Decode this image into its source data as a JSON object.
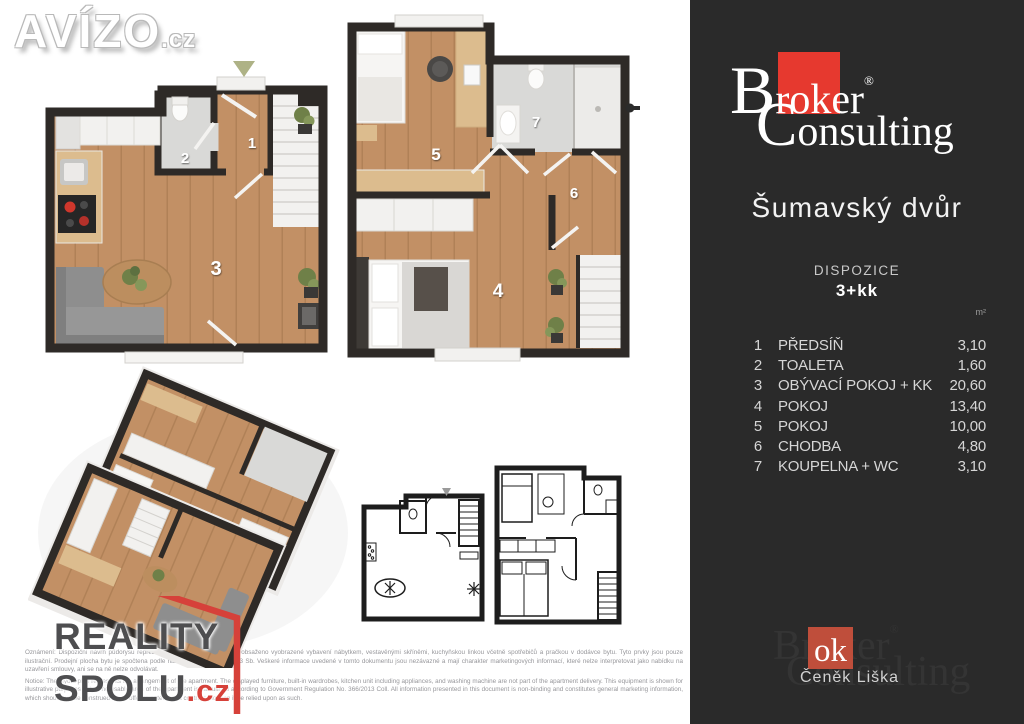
{
  "watermark_logo": {
    "brand": "AVÍZO",
    "tld": ".cz"
  },
  "sidebar": {
    "brand": {
      "cap1": "B",
      "rest1a": "r",
      "ok": "ok",
      "rest1b": "er",
      "reg": "®",
      "cap2": "C",
      "rest2": "onsulting"
    },
    "property_title": "Šumavský dvůr",
    "disposition_label": "DISPOZICE",
    "disposition_value": "3+kk",
    "area_unit": "m²",
    "rooms": [
      {
        "num": "1",
        "name": "PŘEDSÍŇ",
        "area": "3,10"
      },
      {
        "num": "2",
        "name": "TOALETA",
        "area": "1,60"
      },
      {
        "num": "3",
        "name": "OBÝVACÍ POKOJ + KK",
        "area": "20,60"
      },
      {
        "num": "4",
        "name": "POKOJ",
        "area": "13,40"
      },
      {
        "num": "5",
        "name": "POKOJ",
        "area": "10,00"
      },
      {
        "num": "6",
        "name": "CHODBA",
        "area": "4,80"
      },
      {
        "num": "7",
        "name": "KOUPELNA + WC",
        "area": "3,10"
      }
    ],
    "watermark": {
      "line1": "Broker",
      "reg": "®",
      "line2": "Consulting"
    },
    "agent": {
      "badge": "ok",
      "name": "Čeněk Liška"
    }
  },
  "plans": {
    "ground": {
      "labels": {
        "hall": "1",
        "toilet": "2",
        "living": "3"
      }
    },
    "upper": {
      "labels": {
        "room4": "4",
        "room5": "5",
        "corridor": "6",
        "bathroom": "7"
      }
    }
  },
  "footer_logo": {
    "line1": "REALITY",
    "line2": "SPOLU",
    "tld": ".cz"
  },
  "disclaimer": {
    "cz": "Oznámení: Dispoziční návrh půdorysu reprezentuje uspořádání bytu. Není obsaženo vyobrazené vybavení nábytkem, vestavěnými skříněmi, kuchyňskou linkou včetně spotřebičů a pračkou v dodávce bytu. Tyto prvky jsou pouze ilustrační. Prodejní plocha bytu je spočtena podle nařízení vlády č. 366/2013 Sb. Veškeré informace uvedené v tomto dokumentu jsou nezávazné a mají charakter marketingových informací, které nelze interpretovat jako nabídku na uzavření smlouvy, ani se na ně nelze odvolávat.",
    "en": "Notice: The layout plan represents the arrangement of the apartment. The displayed furniture, built-in wardrobes, kitchen unit including appliances, and washing machine are not part of the apartment delivery. This equipment is shown for illustrative purposes only. The usable area of the apartment is calculated according to Government Regulation No. 366/2013 Coll. All information presented in this document is non-binding and constitutes general marketing information, which should not be construed as an offer to enter into a contract, nor can it be relied upon as such."
  },
  "colors": {
    "sidebar_bg": "#2a2a2a",
    "brand_red": "#e6392f",
    "agent_red": "#bf4e3b",
    "reality_red": "#d6413a",
    "reality_gray": "#4e4e50",
    "wall": "#2e2a27",
    "floor_wood": "#c29065",
    "entrance_arrow_olive": "#aeb286"
  }
}
